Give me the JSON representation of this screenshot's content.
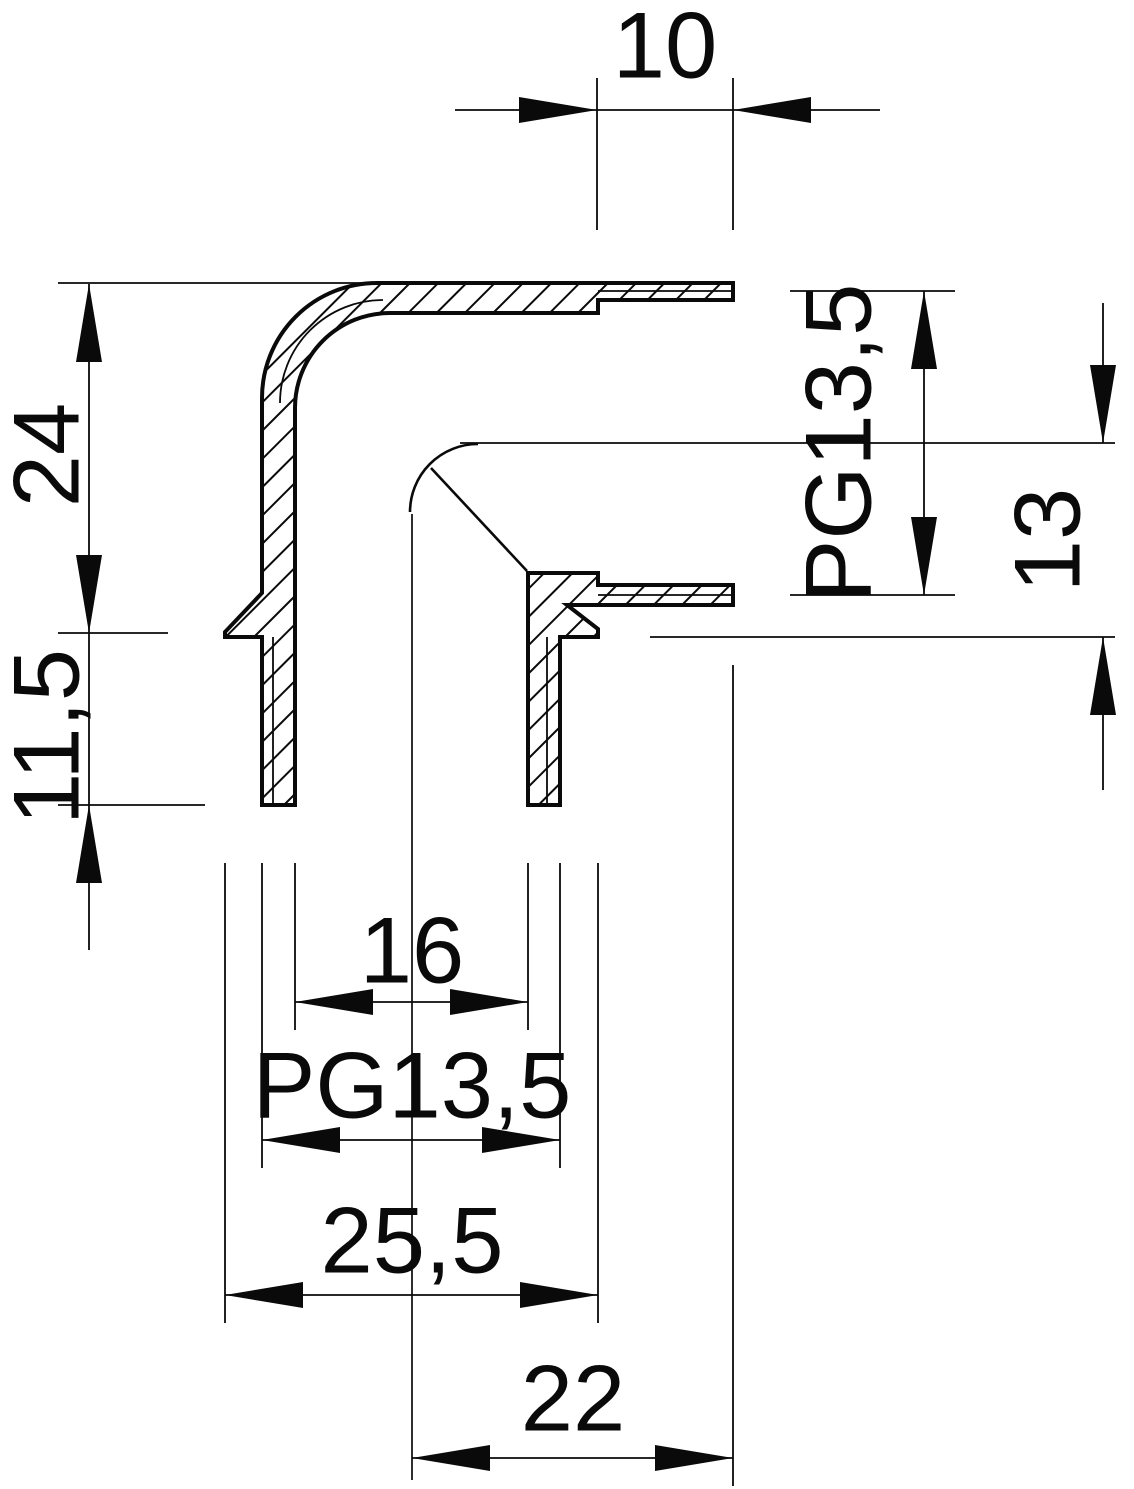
{
  "drawing": {
    "kind": "technical-dimension-drawing",
    "subject": "90-degree elbow conduit fitting, cross-section view",
    "background": "#ffffff",
    "ink": "#0a0a0a",
    "dimensions": [
      {
        "name": "socket-depth-10",
        "label": "10",
        "text": {
          "x": 665,
          "y": 45,
          "rotate": 0
        },
        "lines": [
          [
            455,
            110,
            880,
            110
          ],
          [
            597,
            78,
            597,
            230
          ],
          [
            733,
            78,
            733,
            230
          ]
        ],
        "arrows": [
          {
            "x": 597,
            "y": 110,
            "dir": "right"
          },
          {
            "x": 733,
            "y": 110,
            "dir": "left"
          }
        ]
      },
      {
        "name": "upper-length-24",
        "label": "24",
        "text": {
          "x": 46,
          "y": 455,
          "rotate": -90
        },
        "lines": [
          [
            89,
            284,
            89,
            633
          ],
          [
            58,
            283,
            395,
            283
          ],
          [
            58,
            633,
            168,
            633
          ]
        ],
        "arrows": [
          {
            "x": 89,
            "y": 284,
            "dir": "up"
          },
          {
            "x": 89,
            "y": 633,
            "dir": "down"
          }
        ]
      },
      {
        "name": "spigot-length-11-5",
        "label": "11,5",
        "text": {
          "x": 46,
          "y": 737,
          "rotate": -90
        },
        "lines": [
          [
            89,
            633,
            89,
            950
          ],
          [
            58,
            805,
            205,
            805
          ]
        ],
        "arrows": [
          {
            "x": 89,
            "y": 805,
            "dir": "up"
          }
        ]
      },
      {
        "name": "socket-thread-pg13-5",
        "label": "PG13,5",
        "text": {
          "x": 838,
          "y": 443,
          "rotate": -90
        },
        "lines": [
          [
            924,
            291,
            924,
            595
          ],
          [
            790,
            291,
            955,
            291
          ],
          [
            790,
            595,
            955,
            595
          ]
        ],
        "arrows": [
          {
            "x": 924,
            "y": 291,
            "dir": "up"
          },
          {
            "x": 924,
            "y": 595,
            "dir": "down"
          }
        ]
      },
      {
        "name": "offset-13",
        "label": "13",
        "text": {
          "x": 1047,
          "y": 540,
          "rotate": -90
        },
        "lines": [
          [
            1103,
            303,
            1103,
            443
          ],
          [
            1103,
            637,
            1103,
            790
          ],
          [
            650,
            637,
            1115,
            637
          ]
        ],
        "arrows": [
          {
            "x": 1103,
            "y": 443,
            "dir": "down"
          },
          {
            "x": 1103,
            "y": 637,
            "dir": "up"
          }
        ]
      },
      {
        "name": "bore-16",
        "label": "16",
        "text": {
          "x": 412,
          "y": 950,
          "rotate": 0
        },
        "lines": [
          [
            295,
            1002,
            528,
            1002
          ],
          [
            295,
            863,
            295,
            1030
          ],
          [
            528,
            863,
            528,
            1030
          ]
        ],
        "arrows": [
          {
            "x": 295,
            "y": 1002,
            "dir": "left"
          },
          {
            "x": 528,
            "y": 1002,
            "dir": "right"
          }
        ]
      },
      {
        "name": "spigot-thread-pg13-5",
        "label": "PG13,5",
        "text": {
          "x": 412,
          "y": 1085,
          "rotate": 0
        },
        "lines": [
          [
            262,
            1140,
            560,
            1140
          ],
          [
            262,
            863,
            262,
            1168
          ],
          [
            560,
            863,
            560,
            1168
          ]
        ],
        "arrows": [
          {
            "x": 262,
            "y": 1140,
            "dir": "left"
          },
          {
            "x": 560,
            "y": 1140,
            "dir": "right"
          }
        ]
      },
      {
        "name": "flange-width-25-5",
        "label": "25,5",
        "text": {
          "x": 412,
          "y": 1240,
          "rotate": 0
        },
        "lines": [
          [
            225,
            1295,
            598,
            1295
          ],
          [
            225,
            863,
            225,
            1323
          ],
          [
            598,
            863,
            598,
            1323
          ]
        ],
        "arrows": [
          {
            "x": 225,
            "y": 1295,
            "dir": "left"
          },
          {
            "x": 598,
            "y": 1295,
            "dir": "right"
          }
        ]
      },
      {
        "name": "center-to-mouth-22",
        "label": "22",
        "text": {
          "x": 573,
          "y": 1398,
          "rotate": 0
        },
        "lines": [
          [
            412,
            1458,
            733,
            1458
          ],
          [
            733,
            665,
            733,
            1486
          ]
        ],
        "arrows": [
          {
            "x": 412,
            "y": 1458,
            "dir": "left"
          },
          {
            "x": 733,
            "y": 1458,
            "dir": "right"
          }
        ]
      }
    ]
  }
}
